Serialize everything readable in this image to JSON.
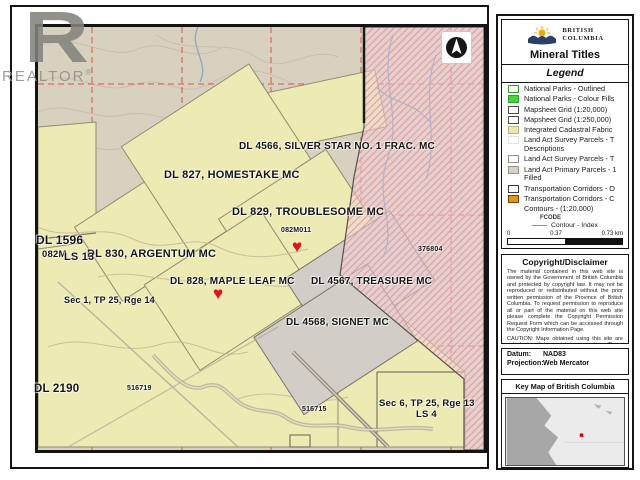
{
  "watermark": {
    "letter": "R",
    "word": "REALTOR",
    "reg": "®"
  },
  "map": {
    "marker_char": "♥",
    "labels": {
      "silver_star": "DL 4566, SILVER STAR NO. 1 FRAC. MC",
      "homestake": "DL 827, HOMESTAKE MC",
      "troublesome": "DL 829, TROUBLESOME MC",
      "mapsheet_small": "082M011",
      "argentum": "DL 830, ARGENTUM MC",
      "dl1596": "DL 1596",
      "m082": "082M",
      "ls13": "LS 13",
      "maple_leaf": "DL 828, MAPLE LEAF MC",
      "treasure": "DL 4567, TREASURE MC",
      "signet": "DL 4568, SIGNET MC",
      "sec1": "Sec 1, TP 25, Rge 14",
      "dl2190": "DL 2190",
      "t516719": "516719",
      "t516715": "516715",
      "sec6": "Sec 6, TP 25, Rge 13",
      "ls4": "LS 4",
      "t376804": "376804"
    },
    "colors": {
      "base": "#d9d1c0",
      "cadastral": "#edeab3",
      "parcel_gray": "#d2cec7",
      "claim_fill": "#f3ced4",
      "claim_hatch": "#d89aa6",
      "grid": "#d9453a",
      "heart": "#e01220"
    }
  },
  "panel": {
    "agency_line1": "BRITISH",
    "agency_line2": "COLUMBIA",
    "title": "Mineral Titles",
    "legend_title": "Legend",
    "legend_items": [
      {
        "label": "National Parks - Outlined",
        "fill": "#fdfdef",
        "border": "#2f9e2f"
      },
      {
        "label": "National Parks - Colour Fills",
        "fill": "#45d53a",
        "border": "#2f9e2f"
      },
      {
        "label": "Mapsheet Grid (1:20,000)",
        "fill": "#ffffff",
        "border": "#4a4a4a"
      },
      {
        "label": "Mapsheet Grid (1:250,000)",
        "fill": "#ffffff",
        "border": "#4a4a4a"
      },
      {
        "label": "Integrated Cadastral Fabric",
        "fill": "#edeaae",
        "border": "#b7b28a"
      },
      {
        "label": "Land Act Survey Parcels - T Descriptions",
        "fill": "#ffffff",
        "border": "#e2e2e2"
      },
      {
        "label": "Land Act Survey Parcels - T",
        "fill": "#ffffff",
        "border": "#8f8f8f"
      },
      {
        "label": "Land Act Primary Parcels - 1 Filled",
        "fill": "#d7d3cb",
        "border": "#98948a"
      },
      {
        "label": "Transportation Corridors - O",
        "fill": "#ffffff",
        "border": "#3a3a3a"
      },
      {
        "label": "Transportation Corridors - C",
        "fill": "#e8940d",
        "border": "#6b4a00"
      },
      {
        "label": "Contours - (1:20,000)",
        "fill": "transparent",
        "border": "transparent"
      }
    ],
    "fcode_heading": "FCODE",
    "contour_index_label": "Contour - Index",
    "scale": {
      "tick0": "0",
      "tick1": "0.37",
      "tick2": "0.73 km",
      "ratio": "1: 18,055"
    },
    "copyright": {
      "title": "Copyright/Disclaimer",
      "body": "The material contained in this web site is owned by the Government of British Columbia and protected by copyright law. It may not be reproduced or redistributed without the prior written permission of the Province of British Columbia. To request permission to reproduce all or part of the material on this web site please complete the Copyright Permission Request Form which can be accessed through the Copyright Information Page.",
      "caution": "CAUTION: Maps obtained using this site are not designed to assist in navigation. These maps may be generalized and may not reflect current conditions. Uncharted hazards may exist. DO NOT USE THESE MAPS FOR NAVIGATIONAL PURPOSES."
    },
    "datum_label": "Datum:",
    "datum_value": "NAD83",
    "projection_label": "Projection:",
    "projection_value": "Web Mercator",
    "keymap_title": "Key Map of British Columbia"
  }
}
